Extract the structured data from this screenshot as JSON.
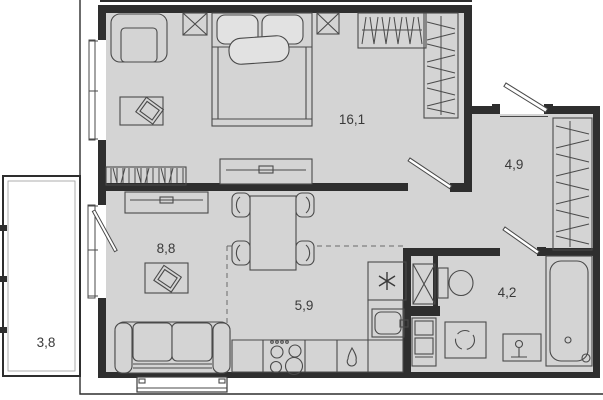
{
  "plan": {
    "rooms": [
      {
        "name": "bedroom",
        "area_label": "16,1"
      },
      {
        "name": "hallway",
        "area_label": "4,9"
      },
      {
        "name": "living-room",
        "area_label": "8,8"
      },
      {
        "name": "kitchen",
        "area_label": "5,9"
      },
      {
        "name": "bathroom",
        "area_label": "4,2"
      },
      {
        "name": "balcony",
        "area_label": "3,8"
      }
    ],
    "colors": {
      "floor": "#d4d4d4",
      "walls": "#2e2e2e",
      "furniture_line": "#4a4a4a",
      "outside": "#ffffff",
      "label_text": "#3a3a3a"
    }
  }
}
